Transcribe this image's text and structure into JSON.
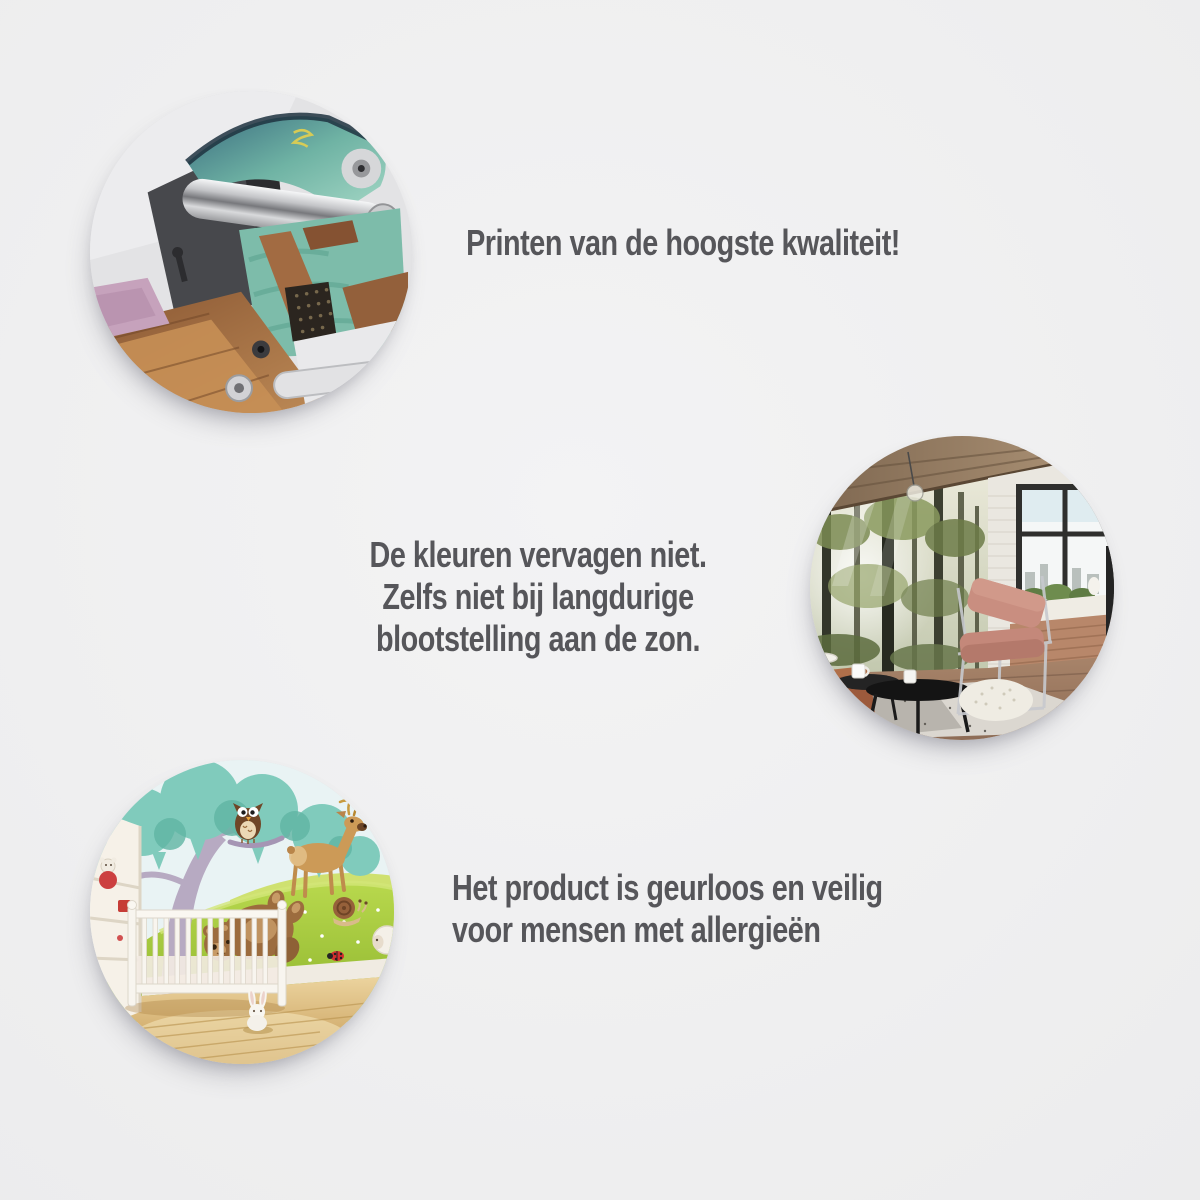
{
  "page": {
    "background_color": "#f0f0f1",
    "text_color": "#56565a"
  },
  "features": [
    {
      "image": "printing-machine-photo",
      "lines": [
        "Printen van de hoogste kwaliteit!"
      ]
    },
    {
      "image": "forest-mural-room-photo",
      "lines": [
        "De kleuren vervagen niet.",
        "Zelfs niet bij langdurige",
        "blootstelling aan de zon."
      ]
    },
    {
      "image": "nursery-animal-mural-photo",
      "lines": [
        "Het product is geurloos en veilig",
        "voor mensen met allergieën"
      ]
    }
  ]
}
